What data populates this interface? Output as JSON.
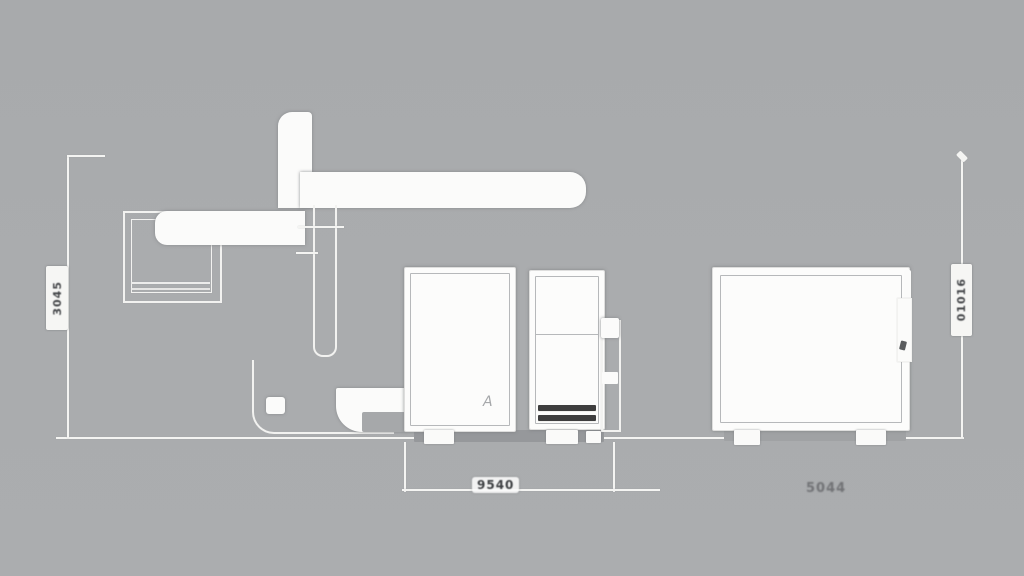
{
  "diagram": {
    "title": "equipment-side-elevation-drawing",
    "dimensions": {
      "left_height_label": "3045",
      "right_height_label": "01016",
      "base_width_label": "9540",
      "right_width_label": "5044"
    },
    "door_glyph": "A",
    "colors": {
      "background": "#aaacae",
      "line_white": "#f4f4f2",
      "solid_white": "#fbfbfa",
      "panel_fill": "#fcfcfb",
      "vent_dark": "#3e3e3e",
      "label_text": "#45474a"
    }
  }
}
